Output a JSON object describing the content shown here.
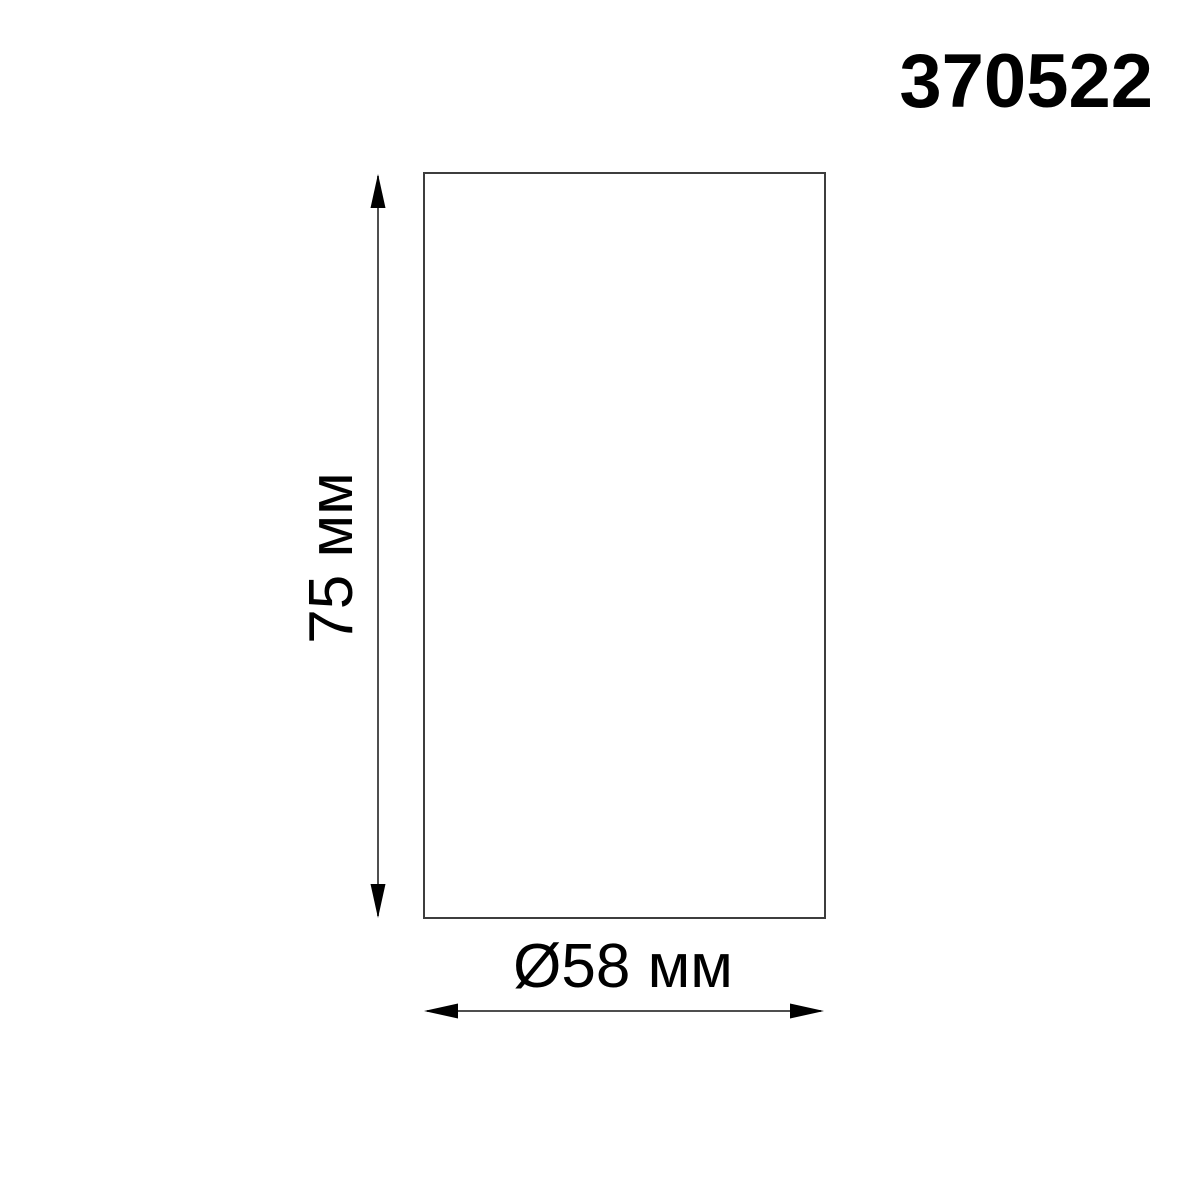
{
  "product_code": "370522",
  "dimensions": {
    "height_label": "75 мм",
    "diameter_label": "Ø58 мм"
  },
  "colors": {
    "outline": "#3d3d3d",
    "dimension_line": "#4f4f4f",
    "arrow": "#000000",
    "text": "#000000",
    "background": "#ffffff"
  }
}
